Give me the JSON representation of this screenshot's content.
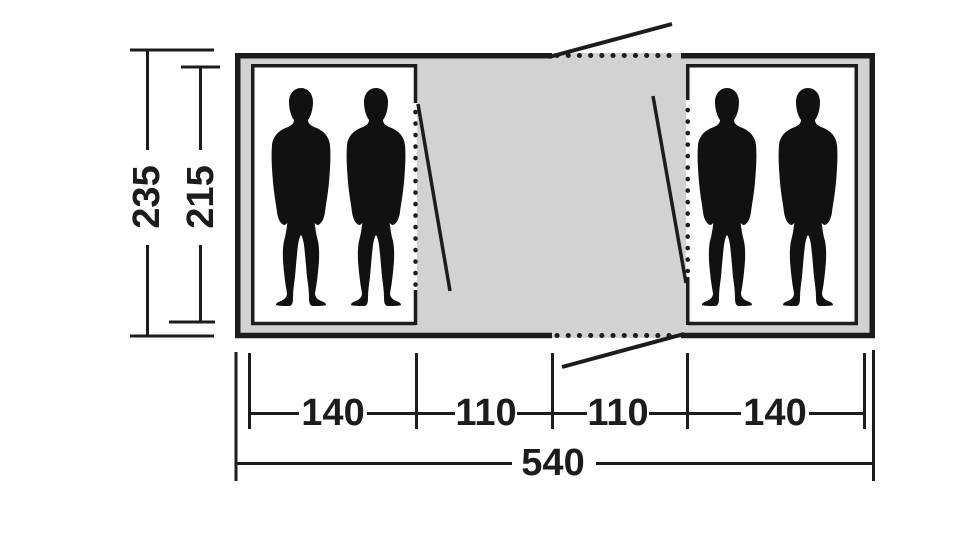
{
  "diagram": {
    "type": "tent floor plan with dimensions (cm)",
    "colors": {
      "outline": "#1c1c1c",
      "living_area_floor": "#d2d2d2",
      "cabin_floor": "#ffffff"
    },
    "height_dimensions": {
      "outer": {
        "label": "235"
      },
      "inner": {
        "label": "215"
      }
    },
    "width_segments": [
      {
        "label": "140"
      },
      {
        "label": "110"
      },
      {
        "label": "110"
      },
      {
        "label": "140"
      }
    ],
    "total_width": {
      "label": "540"
    }
  }
}
